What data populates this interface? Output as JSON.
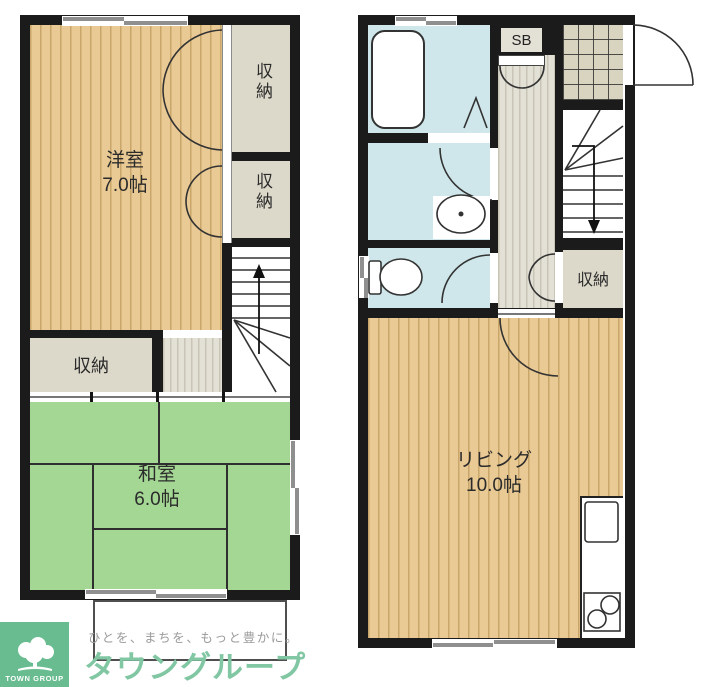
{
  "palette": {
    "wall": "#1b1b1b",
    "line": "#333333",
    "wood": "#e9c994",
    "woodStripe": "#c9a76b",
    "tatami": "#a4d794",
    "tatamiLine": "#2f2f2f",
    "waterBlue": "#cfe7ea",
    "closetGray": "#dcd9ca",
    "hallBase": "#e3e0d5",
    "hallStripe": "#c8c5b6",
    "genkanTile": "#d8d4bf",
    "logoGreen": "#69bc90",
    "brandGreen": "#82c7a4",
    "taglineGray": "#9b9b9b",
    "windowGray": "#8f8f8f"
  },
  "floor2": {
    "western_room": {
      "name": "洋室",
      "size": "7.0帖"
    },
    "closet_top_1": "収納",
    "closet_top_2": "収納",
    "closet_hall": "収納",
    "japanese_room": {
      "name": "和室",
      "size": "6.0帖"
    }
  },
  "floor1": {
    "shoe_box": "SB",
    "closet": "収納",
    "living": {
      "name": "リビング",
      "size": "10.0帖"
    }
  },
  "logo": {
    "tagline": "ひとを、まちを、もっと豊かに。",
    "brand": "タウングループ",
    "brand_en": "TOWN GROUP"
  }
}
